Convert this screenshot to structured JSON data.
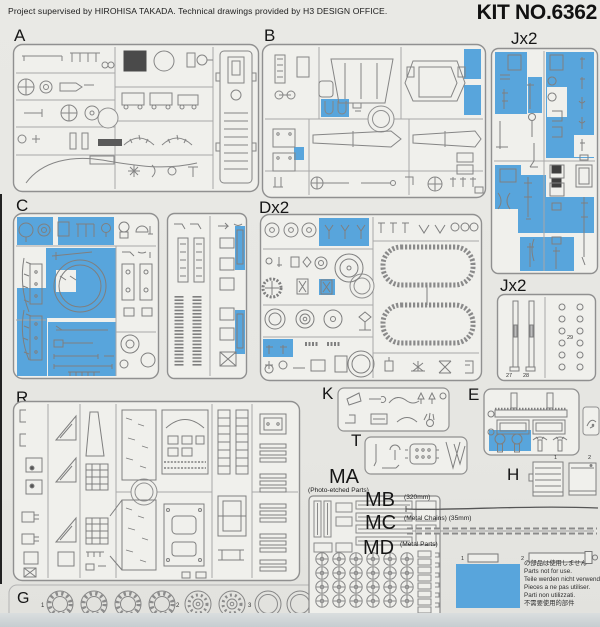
{
  "header": {
    "credit": "Project supervised by HIROHISA TAKADA. Technical drawings provided by H3 DESIGN OFFICE.",
    "kit_no": "KIT NO.6362"
  },
  "colors": {
    "not_for_use_blue": "#58a5dc"
  },
  "panels": {
    "a": {
      "label": "A"
    },
    "b": {
      "label": "B"
    },
    "j_top": {
      "label": "Jx2"
    },
    "j_bottom": {
      "label": "Jx2",
      "parts": [
        "27",
        "28",
        "29"
      ]
    },
    "c": {
      "label": "C"
    },
    "d": {
      "label": "Dx2"
    },
    "r": {
      "label": "R"
    },
    "k": {
      "label": "K"
    },
    "t": {
      "label": "T"
    },
    "e": {
      "label": "E"
    },
    "g": {
      "label": "G",
      "groups": [
        "1",
        "2",
        "3"
      ]
    },
    "h": {
      "label": "H",
      "items": [
        "1",
        "2"
      ]
    }
  },
  "materials": {
    "ma": {
      "label": "MA",
      "sublabel": "(Photo-etched Parts)"
    },
    "mb": {
      "label": "MB",
      "sublabel": "(320mm)"
    },
    "mc": {
      "label": "MC",
      "sublabel": "(Metal Chains) (35mm)"
    },
    "md": {
      "label": "MD",
      "sublabel": "(Metal Parts)",
      "items": [
        "1",
        "2"
      ]
    }
  },
  "legend": {
    "lines": [
      "の部品は使用しません",
      "Parts not for use.",
      "Teile werden nicht verwendet.",
      "Pieces a ne pas utiliser.",
      "Parti non utilizzati.",
      "不需要使用的部件"
    ]
  }
}
